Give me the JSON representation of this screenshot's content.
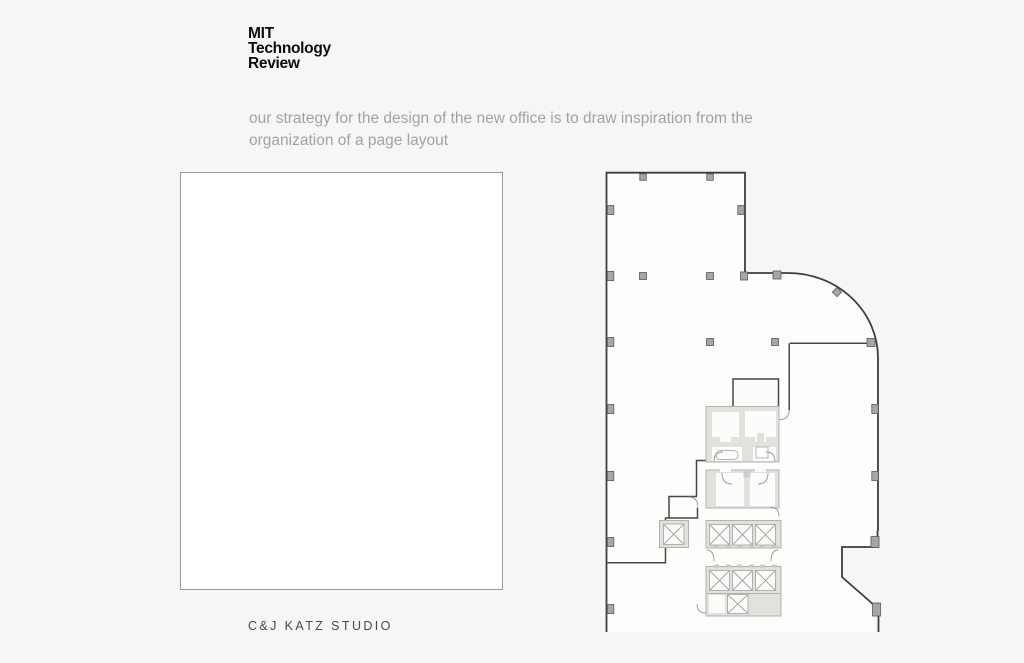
{
  "logo": {
    "line1": "MIT",
    "line2": "Technology",
    "line3": "Review"
  },
  "subtitle": "our strategy for the design of the new office is to draw inspiration from the organization of a page layout",
  "footer": "C&J KATZ STUDIO",
  "floorplan": {
    "kind": "architectural-floor-plan",
    "features": [
      "open-plan-area",
      "column-grid",
      "curved-corner-wall",
      "restroom-core",
      "elevator-banks",
      "door-swings"
    ],
    "elevator_cell_count": 8
  },
  "colors": {
    "slide_background": "#f6f6f7",
    "page_fill": "#ffffff",
    "page_border": "#9a9a9a",
    "logo_text": "#0d0d0d",
    "subtitle_text": "#a2a2a2",
    "footer_text": "#4b4946",
    "plan_wall_dark": "#3e3e3e",
    "plan_wall_gray": "#b3b1ac",
    "plan_core_fill": "#e3e1dc",
    "plan_room_fill": "#fcfcfb",
    "plan_column_fill": "#a8a6a2"
  }
}
